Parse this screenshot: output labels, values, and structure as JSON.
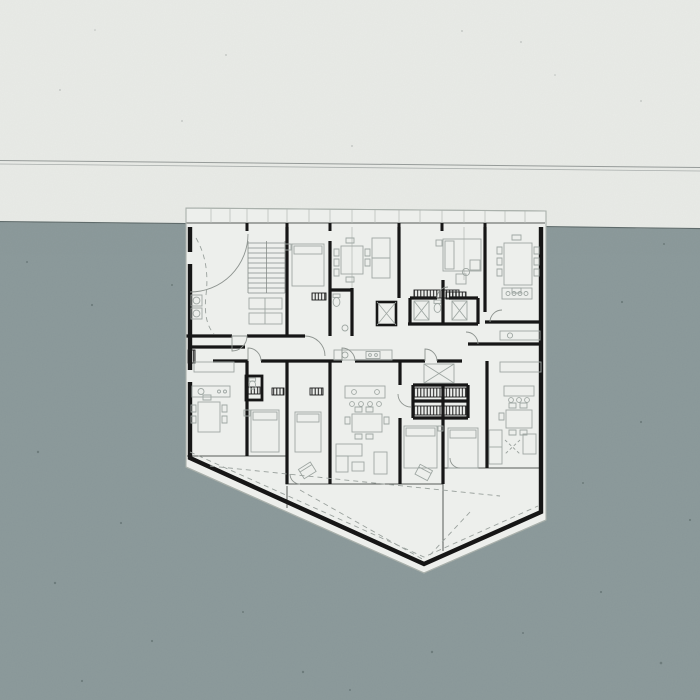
{
  "meta": {
    "description": "Architectural presentation: apartment floor-plan drawing on white paper sheet pinned over a blue-grey board, blank paper band above with a horizontal seam line",
    "canvas": {
      "width": 700,
      "height": 700
    },
    "visible_text": "none"
  },
  "palette": {
    "paper": "#e9ebe7",
    "board": "#8d9b9c",
    "board_edge": "#5f6b6b",
    "sheet": "#edefec",
    "sheet_outline": "#a9b0ab",
    "wall": "#161616",
    "thin_line": "#565b58",
    "light_line": "#b4bab6",
    "furniture": "#9fa7a3",
    "furniture_fill": "#e7eae6",
    "door_arc": "#8d938f",
    "dash_line": "#9aa19d",
    "seam_dark": "#969b99",
    "seam_light": "#a9aeac",
    "comb": "#1b1b1b",
    "speckle_board": "#31403f",
    "speckle_paper": "#7d8482"
  },
  "scene": {
    "upper_region": "blank textured paper",
    "seam": "double horizontal rule, slightly sloped",
    "lower_region": "blue-grey textured board",
    "plan_sheet": "five-sided white sheet, pointed at bottom",
    "plan_contents": [
      "stair core",
      "elevator",
      "bathroom cores with closets",
      "bedrooms with beds",
      "dining tables with chairs",
      "kitchen counters and islands",
      "corridor spine",
      "triangular terrace with dashed guides"
    ]
  }
}
